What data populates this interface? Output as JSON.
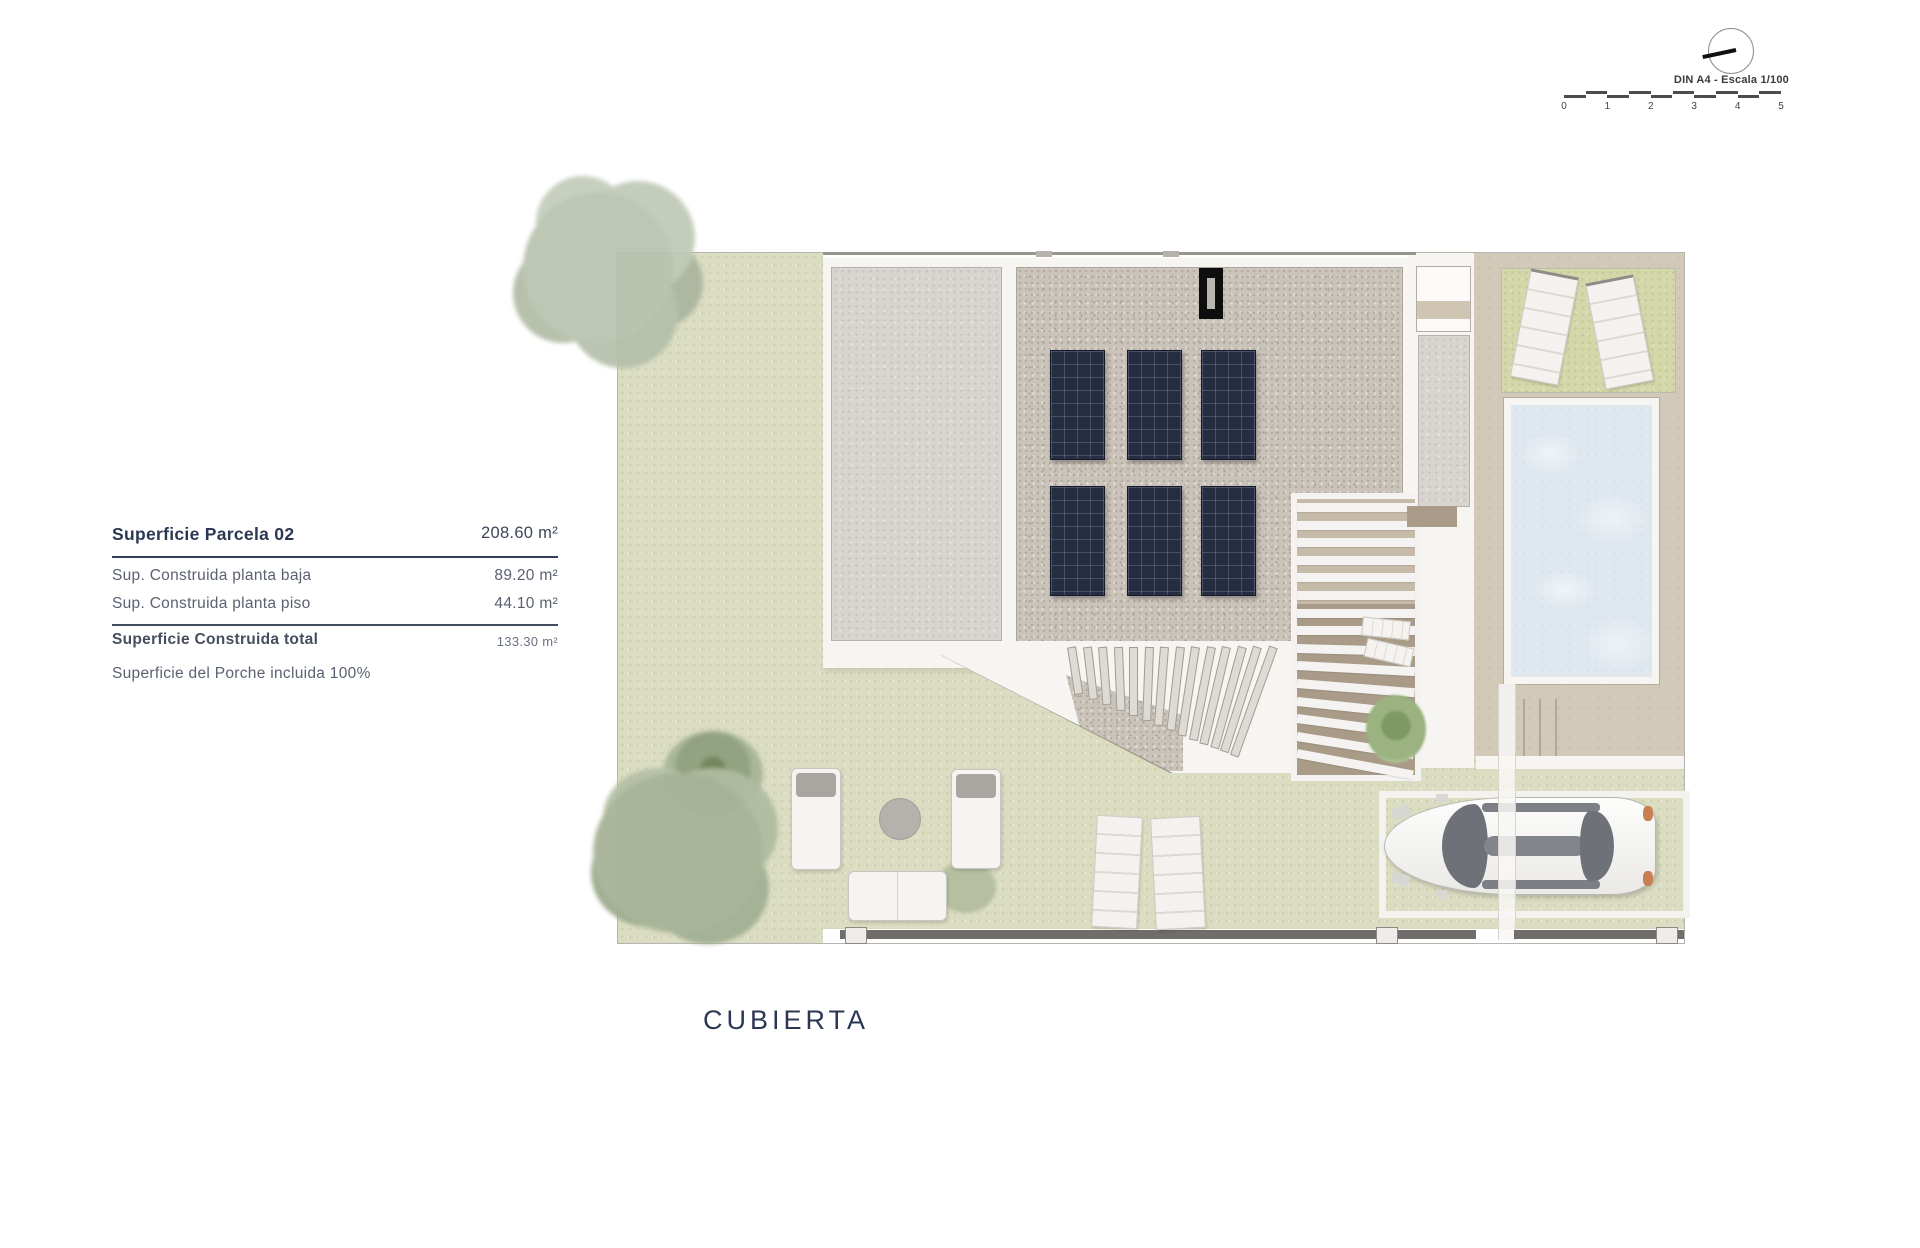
{
  "scale_indicator": {
    "label": "DIN A4 - Escala 1/100",
    "ticks": [
      "0",
      "1",
      "2",
      "3",
      "4",
      "5"
    ]
  },
  "area_table": {
    "title": {
      "label": "Superficie Parcela 02",
      "value": "208.60 m²"
    },
    "rows": [
      {
        "label": "Sup. Construida planta baja",
        "value": "89.20 m²"
      },
      {
        "label": "Sup. Construida planta piso",
        "value": "44.10 m²"
      }
    ],
    "total": {
      "label": "Superficie Construida total",
      "value": "133.30 m²"
    },
    "note": "Superficie del Porche incluida 100%"
  },
  "plan": {
    "title": "CUBIERTA",
    "features": [
      "roof-gravel",
      "solar-panel-array",
      "chimney",
      "pergola-louvers",
      "porch-fan",
      "pool",
      "sun-loungers",
      "garden",
      "parked-car",
      "outdoor-lounge-set",
      "fence"
    ]
  },
  "colors": {
    "accent_navy": "#2c3853",
    "grass": "#dbddc2",
    "grass_patch": "#d3d7aa",
    "gravel_light": "#d8d5d0",
    "gravel_dark": "#c9c3ba",
    "pool_water": "#e0e8ef",
    "paving_tan": "#d2c9b9",
    "deck_brown": "#a99b88",
    "solar_panel": "#262d41",
    "fence_gray": "#716d6b"
  }
}
